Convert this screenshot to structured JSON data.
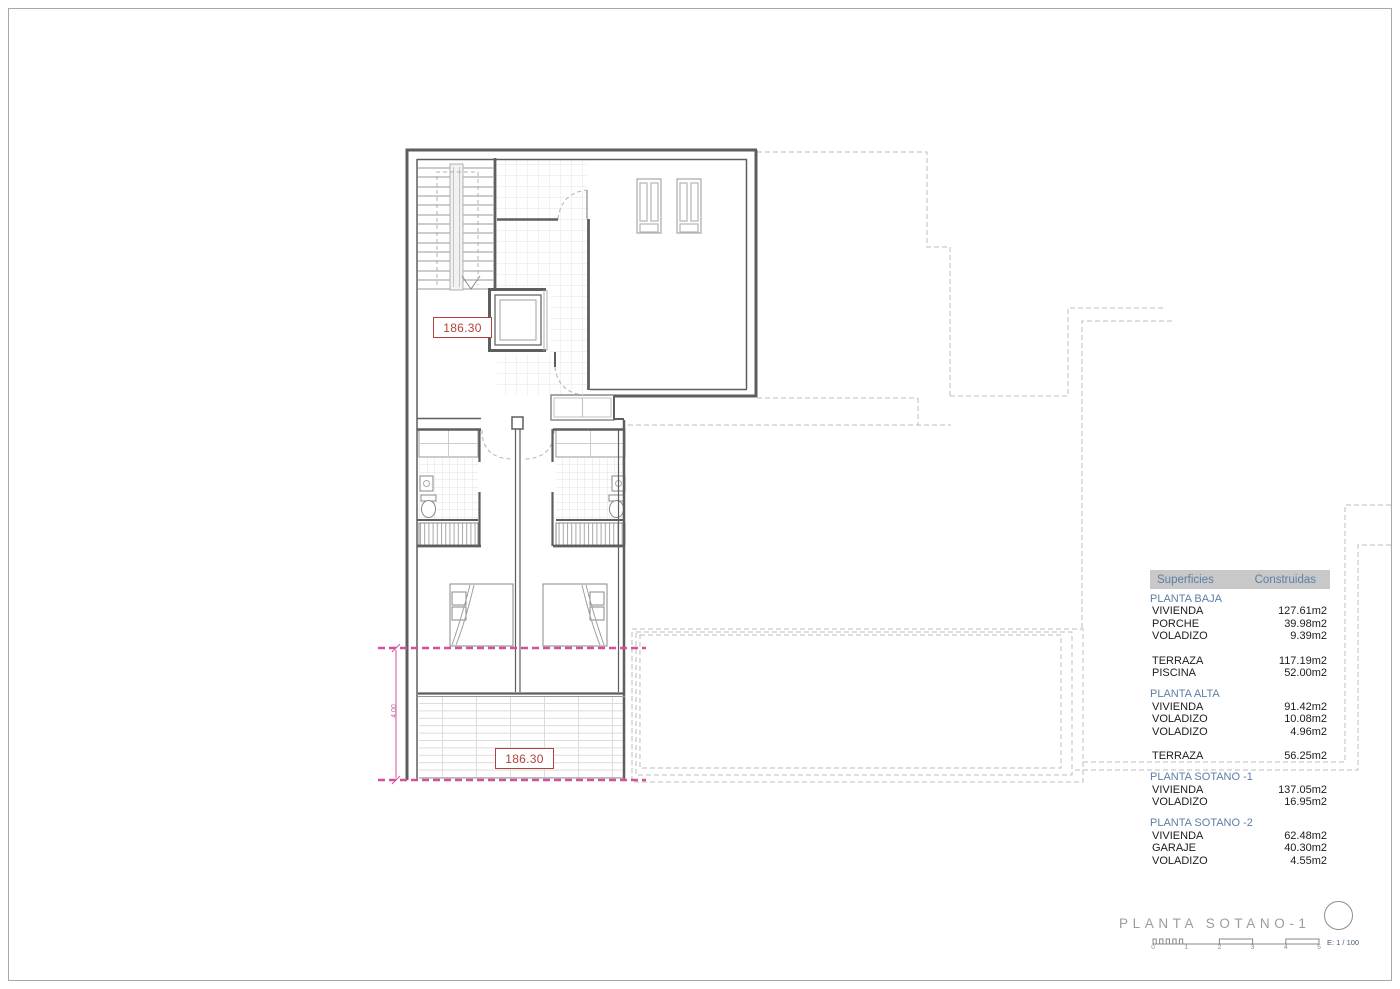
{
  "colors": {
    "wall_gray": "#5e5e5e",
    "projection_dashed_gray": "#bcbcbc",
    "dimension_magenta": "#d4509e",
    "level_label_red": "#b0423a",
    "accent_blue": "#5b7fa6",
    "table_header_bg": "#c8c8c8",
    "title_gray": "#9c9c9c"
  },
  "plan": {
    "area_label_upper": "186.30",
    "area_label_lower": "186.30",
    "terrace_depth_dim": "4.00"
  },
  "surfaces_table": {
    "header": {
      "col_surfaces": "Superficies",
      "col_construidas": "Construidas"
    },
    "sections": [
      {
        "title": "PLANTA BAJA",
        "rows": [
          [
            "VIVIENDA",
            "127.61m2"
          ],
          [
            "PORCHE",
            "39.98m2"
          ],
          [
            "VOLADIZO",
            "9.39m2"
          ]
        ]
      },
      {
        "title": "",
        "rows": [
          [
            "TERRAZA",
            "117.19m2"
          ],
          [
            "PISCINA",
            "52.00m2"
          ]
        ]
      },
      {
        "title": "PLANTA ALTA",
        "rows": [
          [
            "VIVIENDA",
            "91.42m2"
          ],
          [
            "VOLADIZO",
            "10.08m2"
          ],
          [
            "VOLADIZO",
            "4.96m2"
          ]
        ]
      },
      {
        "title": "",
        "rows": [
          [
            "TERRAZA",
            "56.25m2"
          ]
        ]
      },
      {
        "title": "PLANTA SOTANO -1",
        "rows": [
          [
            "VIVIENDA",
            "137.05m2"
          ],
          [
            "VOLADIZO",
            "16.95m2"
          ]
        ]
      },
      {
        "title": "PLANTA SOTANO -2",
        "rows": [
          [
            "VIVIENDA",
            "62.48m2"
          ],
          [
            "GARAJE",
            "40.30m2"
          ],
          [
            "VOLADIZO",
            "4.55m2"
          ]
        ]
      }
    ]
  },
  "title_block": {
    "title": "PLANTA SOTANO-1",
    "scale_text": "E: 1 / 100",
    "scale_ticks": [
      "0",
      "1",
      "2",
      "3",
      "4",
      "5"
    ]
  }
}
